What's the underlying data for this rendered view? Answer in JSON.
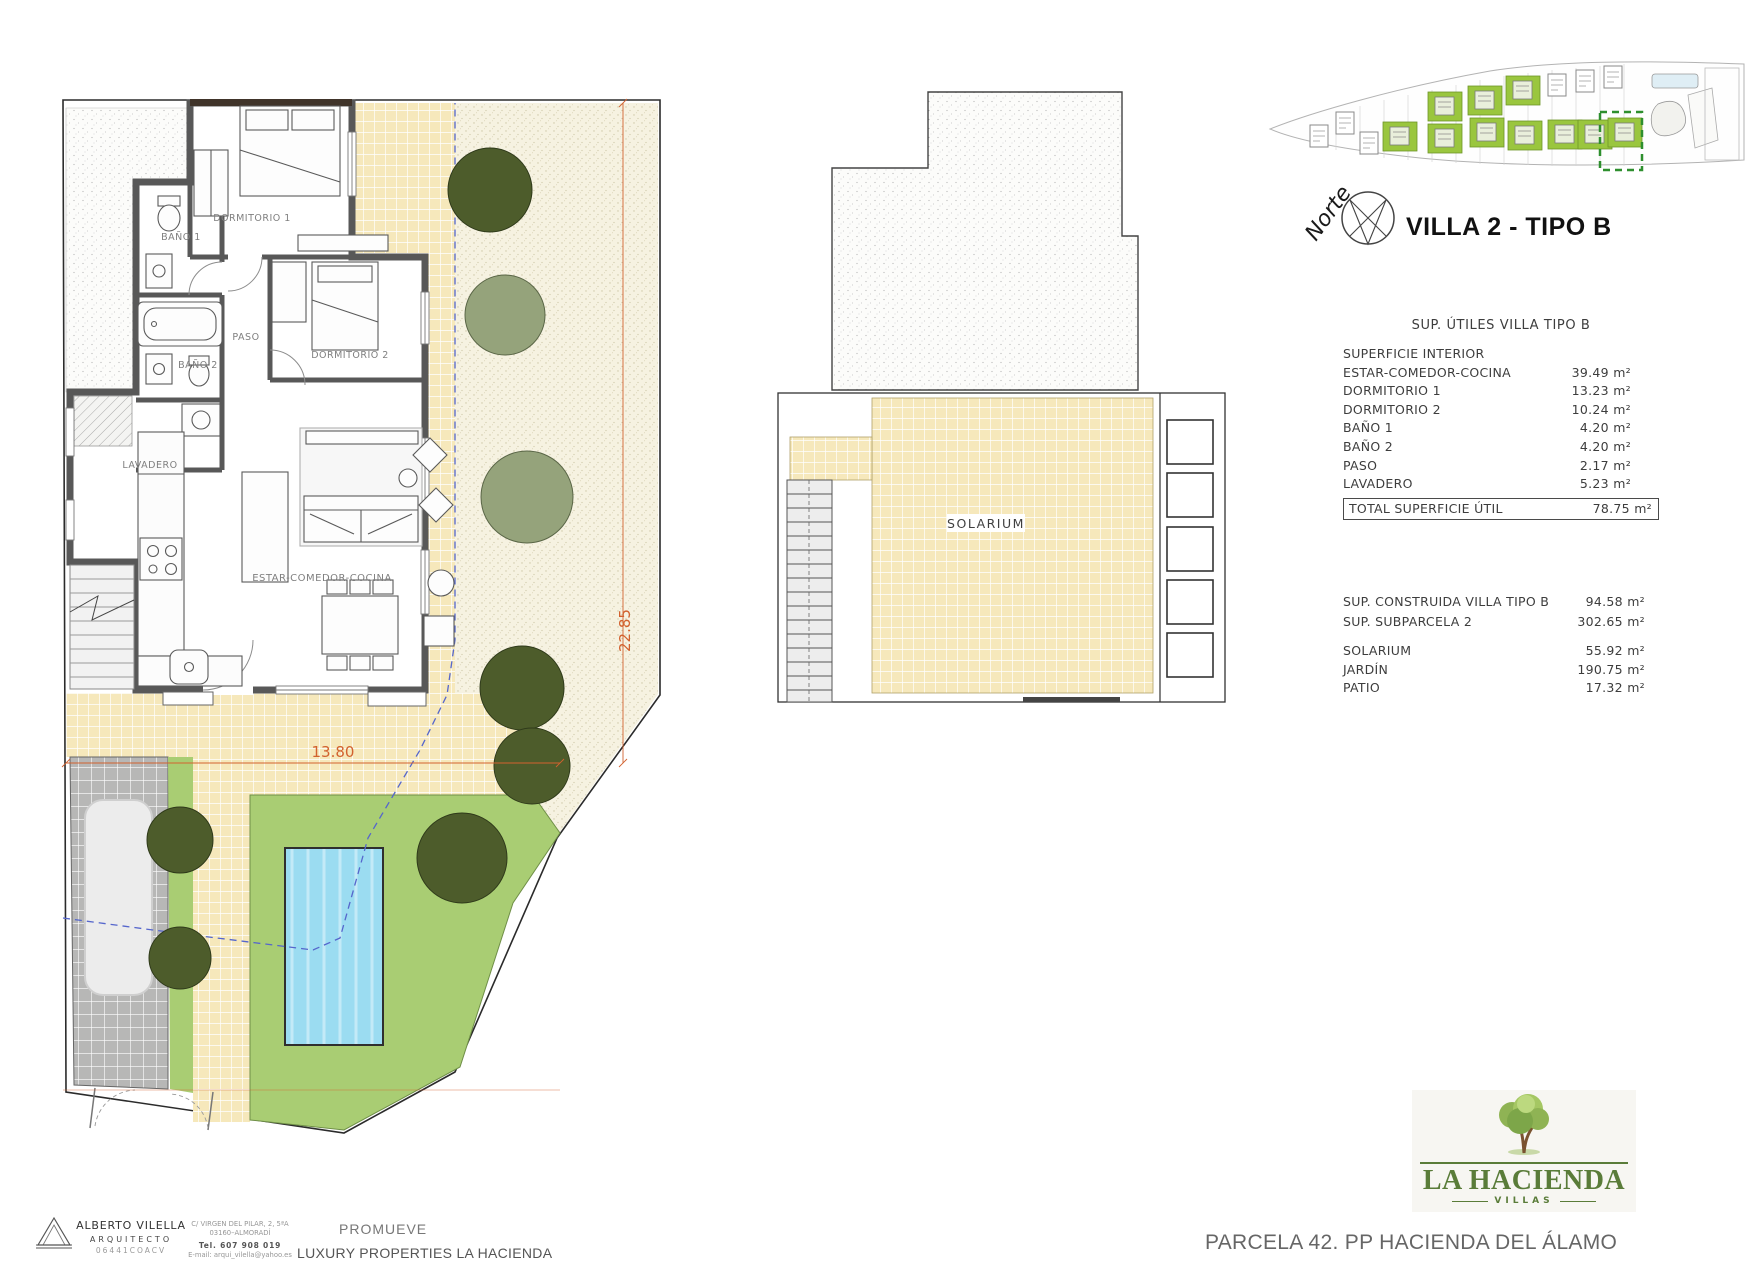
{
  "header": {
    "compass_label": "Norte",
    "title": "VILLA 2 - TIPO B"
  },
  "floor_plan": {
    "rooms": {
      "dormitorio1": "DORMITORIO 1",
      "dormitorio2": "DORMITORIO 2",
      "bano1": "BAÑO 1",
      "bano2": "BAÑO 2",
      "paso": "PASO",
      "lavadero": "LAVADERO",
      "estar": "ESTAR-COMEDOR-COCINA"
    },
    "dimensions": {
      "depth": "22.85",
      "width": "13.80"
    }
  },
  "solarium_plan": {
    "label": "SOLARIUM"
  },
  "areas_table": {
    "title": "SUP. ÚTILES VILLA TIPO B",
    "rows": [
      {
        "label": "SUPERFICIE INTERIOR",
        "value": ""
      },
      {
        "label": "ESTAR-COMEDOR-COCINA",
        "value": "39.49 m²"
      },
      {
        "label": "DORMITORIO 1",
        "value": "13.23 m²"
      },
      {
        "label": "DORMITORIO 2",
        "value": "10.24 m²"
      },
      {
        "label": "BAÑO 1",
        "value": "4.20 m²"
      },
      {
        "label": "BAÑO 2",
        "value": "4.20 m²"
      },
      {
        "label": "PASO",
        "value": "2.17 m²"
      },
      {
        "label": "LAVADERO",
        "value": "5.23 m²"
      }
    ],
    "total": {
      "label": "TOTAL SUPERFICIE ÚTIL",
      "value": "78.75 m²"
    }
  },
  "summary_table": {
    "built": [
      {
        "label": "SUP. CONSTRUIDA VILLA TIPO B",
        "value": "94.58 m²"
      },
      {
        "label": "SUP. SUBPARCELA 2",
        "value": "302.65 m²"
      }
    ],
    "outdoor": [
      {
        "label": "SOLARIUM",
        "value": "55.92 m²"
      },
      {
        "label": "JARDÍN",
        "value": "190.75 m²"
      },
      {
        "label": "PATIO",
        "value": "17.32 m²"
      }
    ]
  },
  "footer": {
    "architect": {
      "name": "ALBERTO VILELLA",
      "role": "ARQUITECTO",
      "license": "06441COACV"
    },
    "contact": {
      "address1": "C/ VIRGEN DEL PILAR, 2, 5ªA",
      "address2": "03160–ALMORADÍ",
      "phone": "Tel. 607 908 019",
      "email": "E-mail: arqui_vilella@yahoo.es"
    },
    "promoter": {
      "heading": "PROMUEVE",
      "name": "LUXURY PROPERTIES LA HACIENDA"
    },
    "brand": {
      "name": "LA HACIENDA",
      "subtitle": "VILLAS"
    },
    "parcel": "PARCELA 42. PP HACIENDA DEL ÁLAMO"
  },
  "colors": {
    "terrace_tile": "#f6e8bb",
    "garden_green": "#a9cd73",
    "pool_blue": "#9bdcf1",
    "tree_dark": "#4d5c2b",
    "tree_light": "#95a37b",
    "dimension_orange": "#d2622f",
    "brand_green": "#5a7c39",
    "highlight_green": "#2e8f2e"
  }
}
